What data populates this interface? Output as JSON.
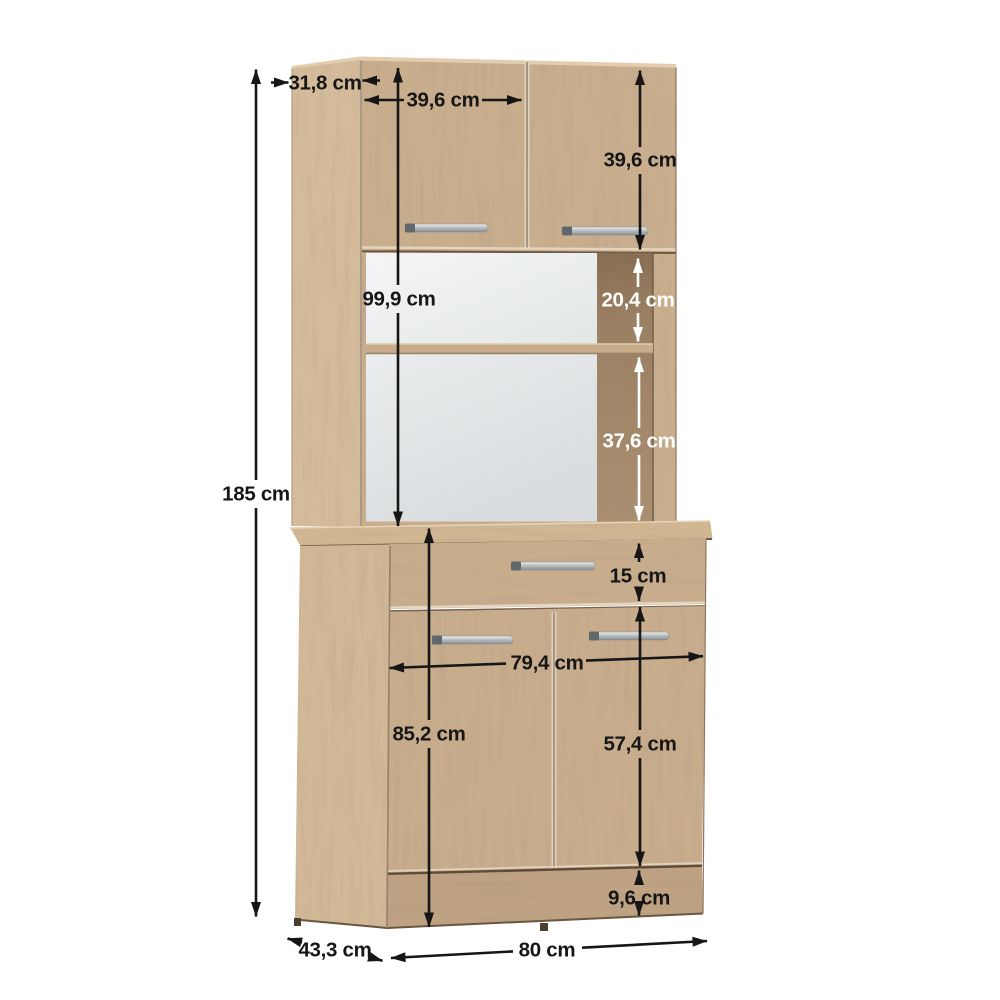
{
  "diagram": {
    "unit": "cm",
    "colors": {
      "wood_light": "#d3bb9b",
      "wood_front": "#c9ae8e",
      "wood_interior_dark": "#9c8165",
      "niche_back": "#eceff0",
      "plinth": "#bea283",
      "handle_silver": "#b9bec0",
      "dimension_black": "#161616",
      "dimension_white": "#ffffff"
    },
    "dimensions": {
      "total_height": "185 cm",
      "hutch_depth": "31,8 cm",
      "hutch_door_width": "39,6 cm",
      "hutch_door_height": "39,6 cm",
      "hutch_height": "99,9 cm",
      "niche_upper_height": "20,4 cm",
      "niche_lower_height": "37,6 cm",
      "drawer_height": "15 cm",
      "base_inner_width": "79,4 cm",
      "base_height": "85,2 cm",
      "base_door_height": "57,4 cm",
      "plinth_height": "9,6 cm",
      "base_depth": "43,3 cm",
      "total_width": "80 cm"
    }
  }
}
